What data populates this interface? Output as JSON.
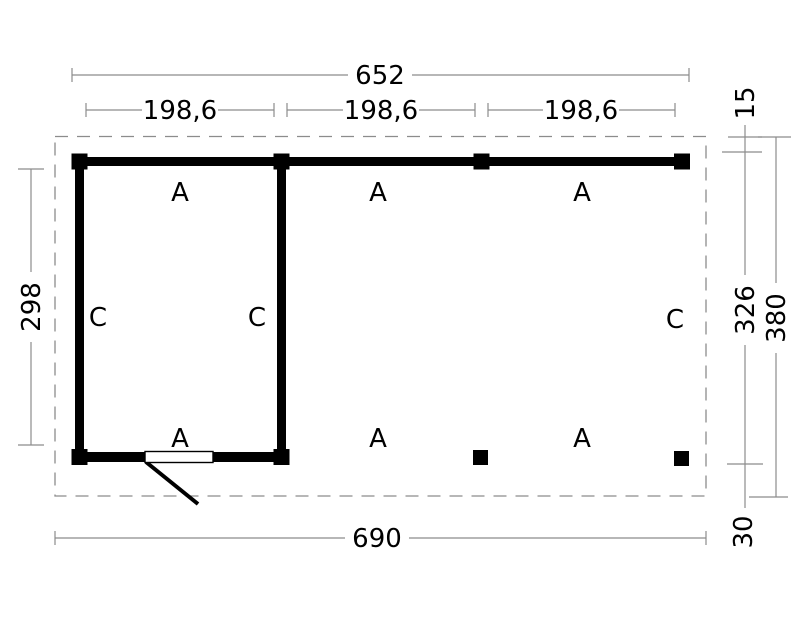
{
  "plan": {
    "dim_top_total": "652",
    "dim_bays": [
      "198,6",
      "198,6",
      "198,6"
    ],
    "dim_right_top": "15",
    "dim_right_inner": "326",
    "dim_right_total": "380",
    "dim_right_bottom": "30",
    "dim_left_room": "298",
    "dim_bottom_total": "690",
    "a_labels": [
      "A",
      "A",
      "A",
      "A",
      "A",
      "A"
    ],
    "c_labels": [
      "C",
      "C",
      "C"
    ]
  },
  "colors": {
    "wall": "#000000",
    "dimension_line": "#8c8c8c",
    "background": "#ffffff",
    "text": "#000000"
  }
}
